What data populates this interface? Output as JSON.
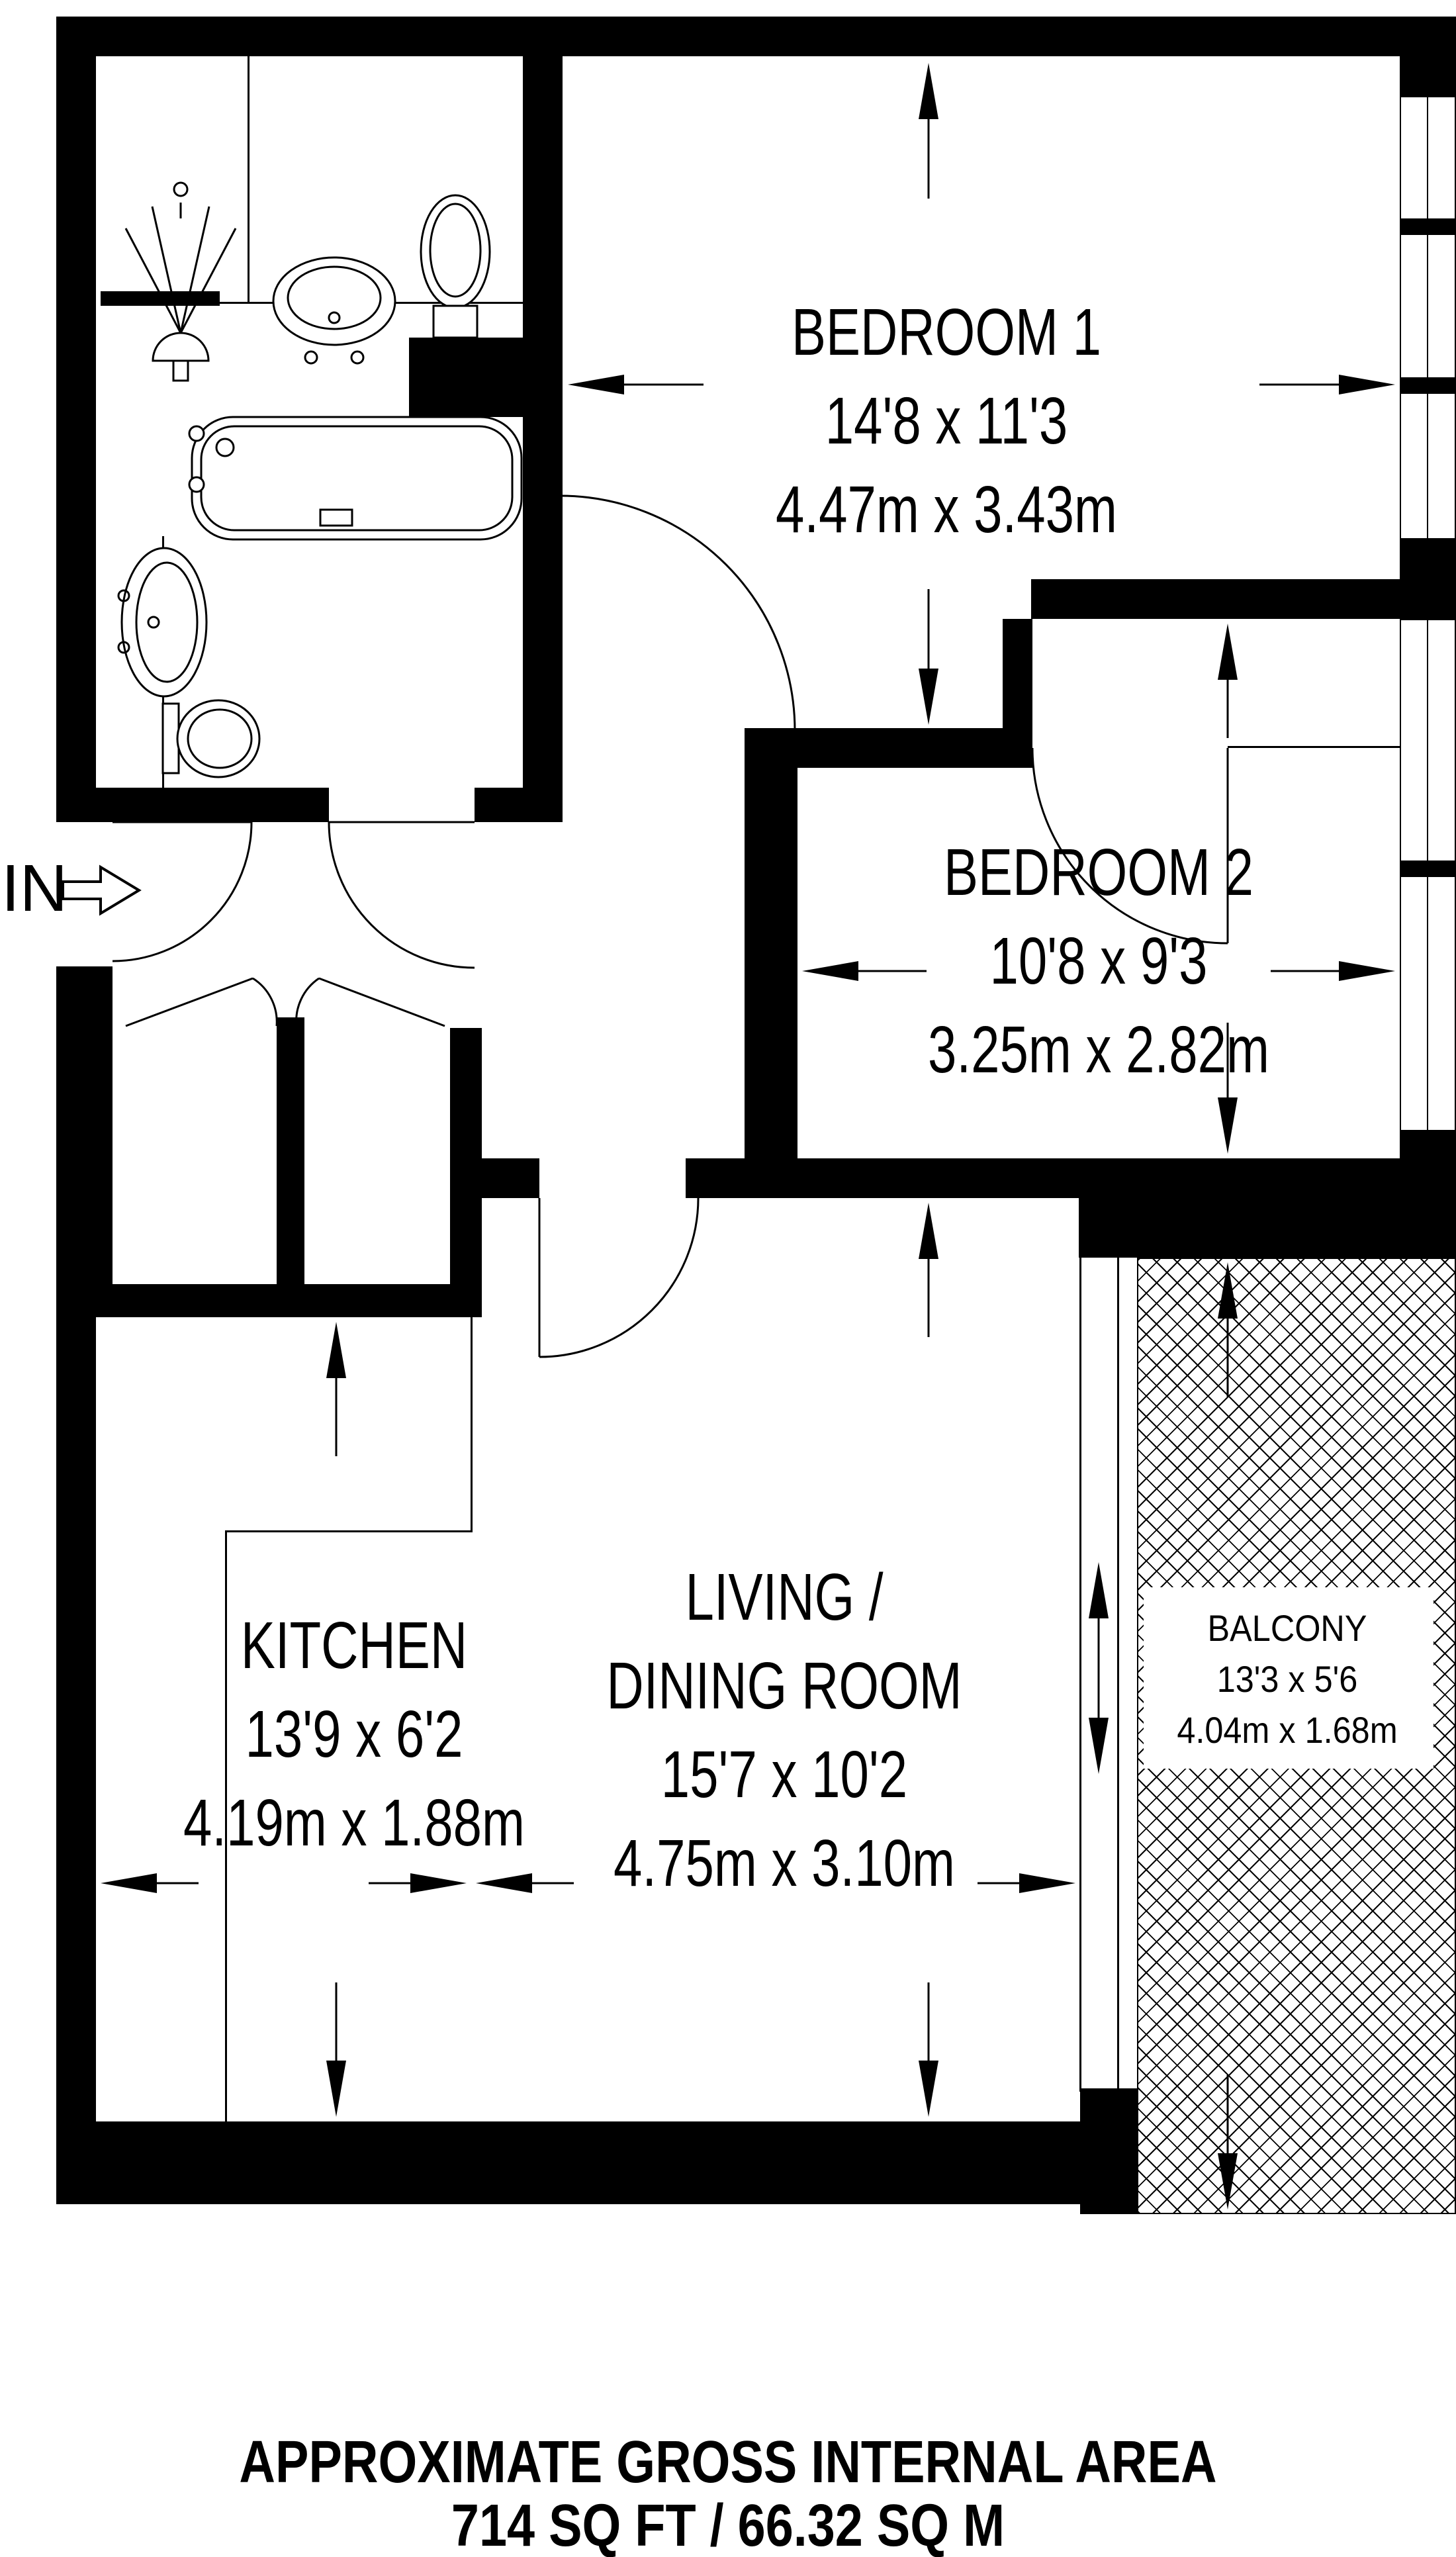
{
  "colors": {
    "wall": "#000000",
    "background": "#ffffff",
    "line": "#000000"
  },
  "entrance": {
    "label": "IN"
  },
  "rooms": [
    {
      "id": "bedroom1",
      "lines": [
        "BEDROOM 1",
        "14'8 x 11'3",
        "4.47m x 3.43m"
      ]
    },
    {
      "id": "bedroom2",
      "lines": [
        "BEDROOM 2",
        "10'8 x 9'3",
        "3.25m x 2.82m"
      ]
    },
    {
      "id": "kitchen",
      "lines": [
        "KITCHEN",
        "13'9 x 6'2",
        "4.19m x 1.88m"
      ]
    },
    {
      "id": "living",
      "lines": [
        "LIVING /",
        "DINING ROOM",
        "15'7 x 10'2",
        "4.75m x 3.10m"
      ]
    },
    {
      "id": "balcony",
      "lines": [
        "BALCONY",
        "13'3 x 5'6",
        "4.04m x 1.68m"
      ]
    }
  ],
  "title_block": {
    "line1": "APPROXIMATE GROSS INTERNAL AREA",
    "line2": "714 SQ FT / 66.32 SQ M"
  },
  "fixtures": [
    "shower",
    "washbasin",
    "toilet",
    "bathtub",
    "washbasin",
    "toilet"
  ],
  "icons": [
    "entrance-arrow",
    "door-swing",
    "dimension-arrow",
    "double-dimension-arrow"
  ]
}
